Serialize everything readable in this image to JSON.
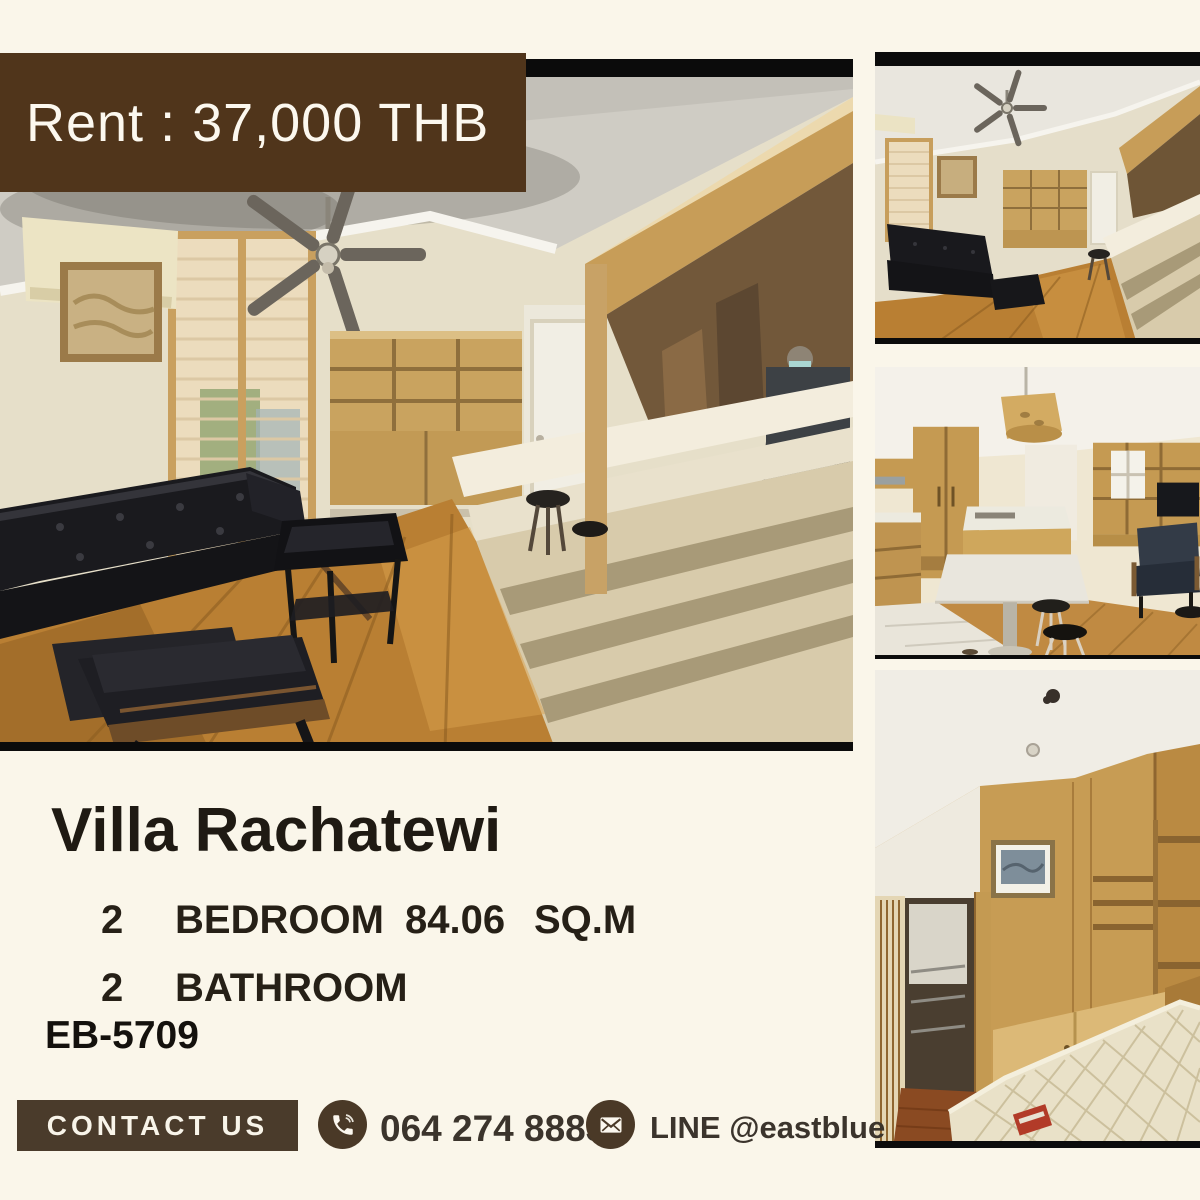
{
  "badge": {
    "rent_label": "Rent : 37,000 THB"
  },
  "listing": {
    "title": "Villa Rachatewi",
    "bedroom_count": "2",
    "bedroom_label": "BEDROOM",
    "area_value": "84.06",
    "area_unit": "SQ.M",
    "bathroom_count": "2",
    "bathroom_label": "BATHROOM",
    "ref_code": "EB-5709"
  },
  "contact": {
    "button_label": "CONTACT US",
    "phone": "064 274 8883",
    "line": "LINE @eastblue",
    "phone_icon": "phone-icon",
    "line_icon": "envelope-icon"
  },
  "colors": {
    "background": "#FAF6EA",
    "banner_brown": "#50351B",
    "contact_brown": "#4A3B2B",
    "text_dark": "#1F1A13",
    "photo_letterbox": "#0B0B0B"
  },
  "photos": [
    {
      "name": "living-room-main"
    },
    {
      "name": "living-room-angle"
    },
    {
      "name": "kitchen-dining"
    },
    {
      "name": "bedroom"
    }
  ]
}
